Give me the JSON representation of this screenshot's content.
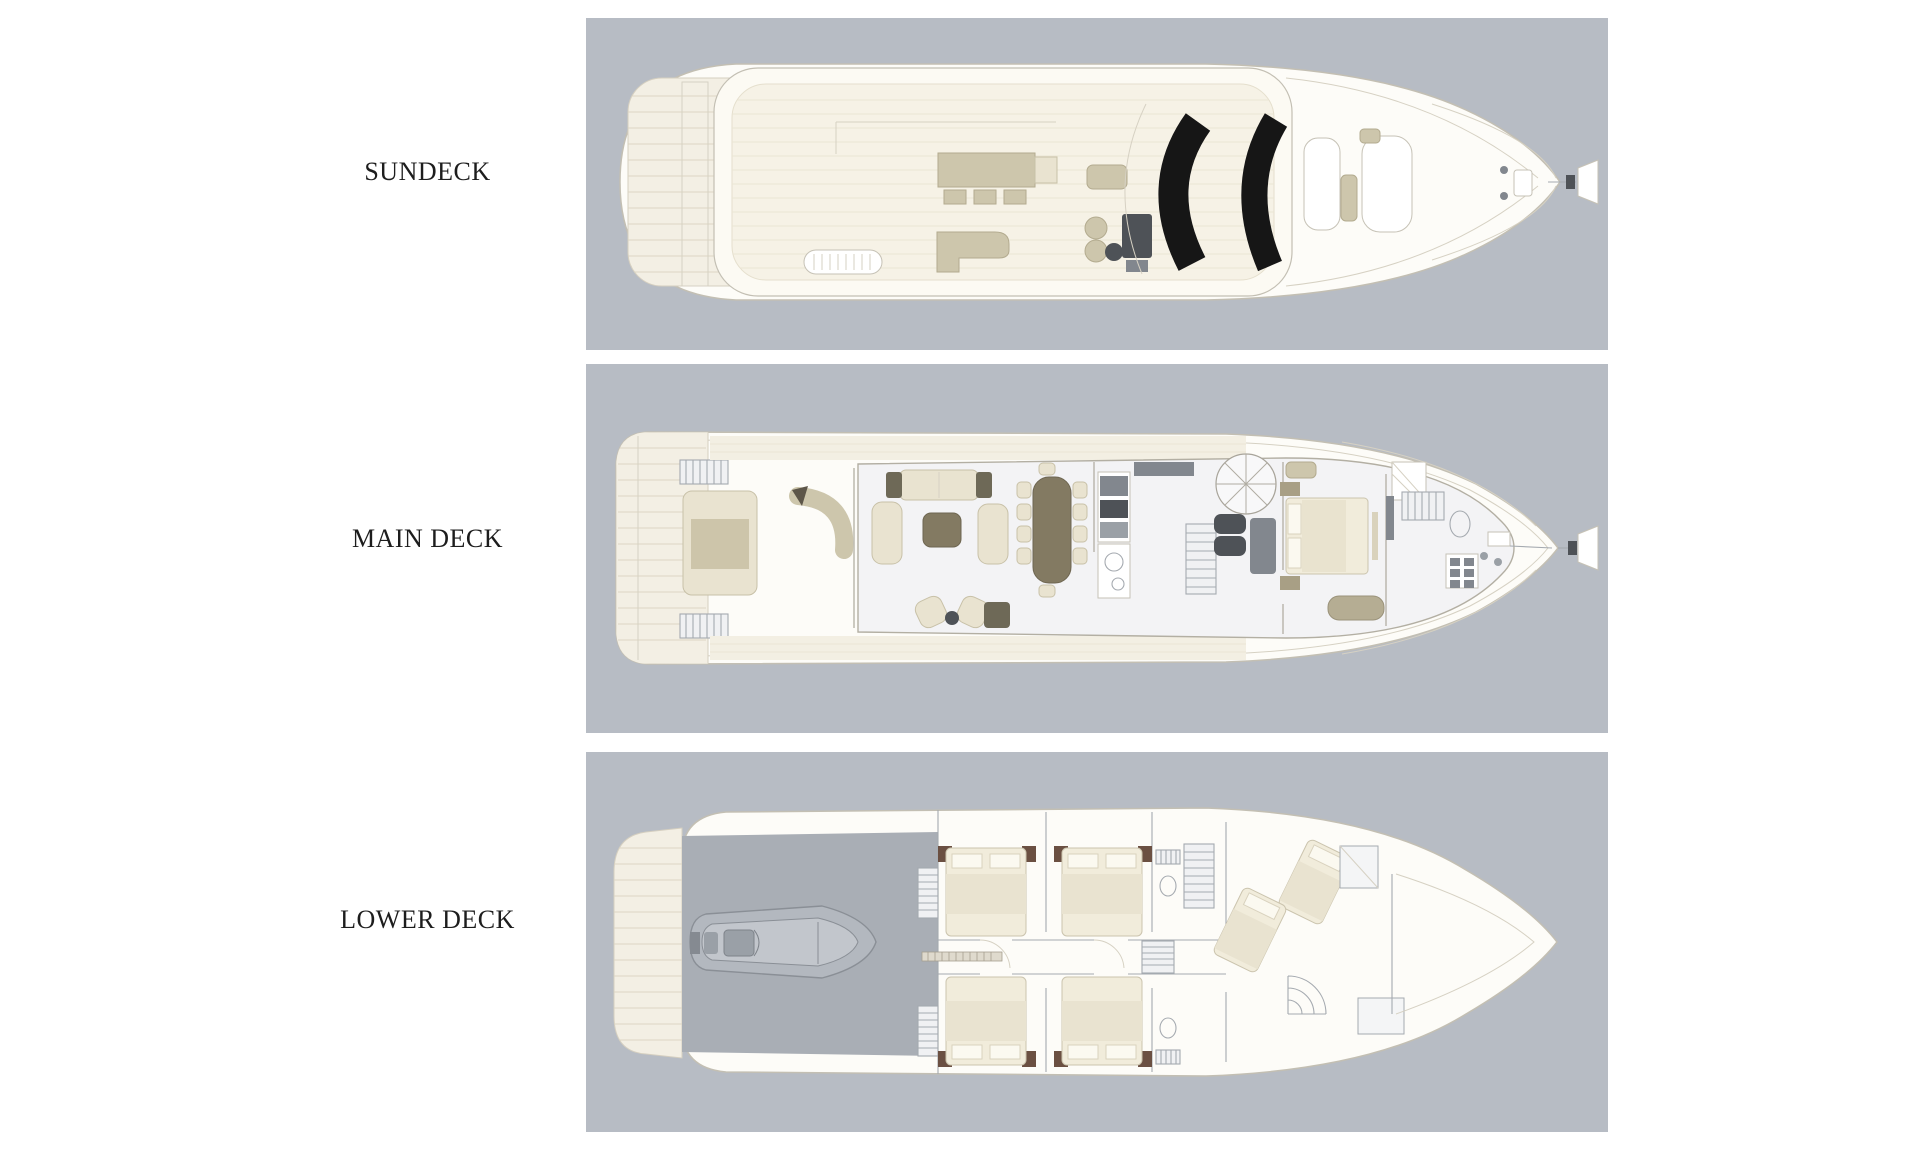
{
  "page": {
    "background": "#ffffff"
  },
  "decks": [
    {
      "id": "sundeck",
      "label": "SUNDECK"
    },
    {
      "id": "main-deck",
      "label": "MAIN DECK"
    },
    {
      "id": "lower-deck",
      "label": "LOWER DECK"
    }
  ],
  "colors": {
    "panel_bg": "#b7bcc4",
    "garage_overlay": "#a9aeb5",
    "deck_cream": "#f3efe4",
    "plank_line": "#dcd5c3",
    "outline_gray": "#c3bfb3",
    "furniture_tan": "#cdc6ac",
    "furniture_beige": "#e9e3d0",
    "table_brown": "#837a62",
    "accent_olive": "#6e6957",
    "equipment_gray": "#82878e",
    "helm_dark": "#4e5257",
    "sunroof_black": "#161616",
    "cabin_accent": "#6b5042",
    "label_text": "#1d1d1d"
  }
}
